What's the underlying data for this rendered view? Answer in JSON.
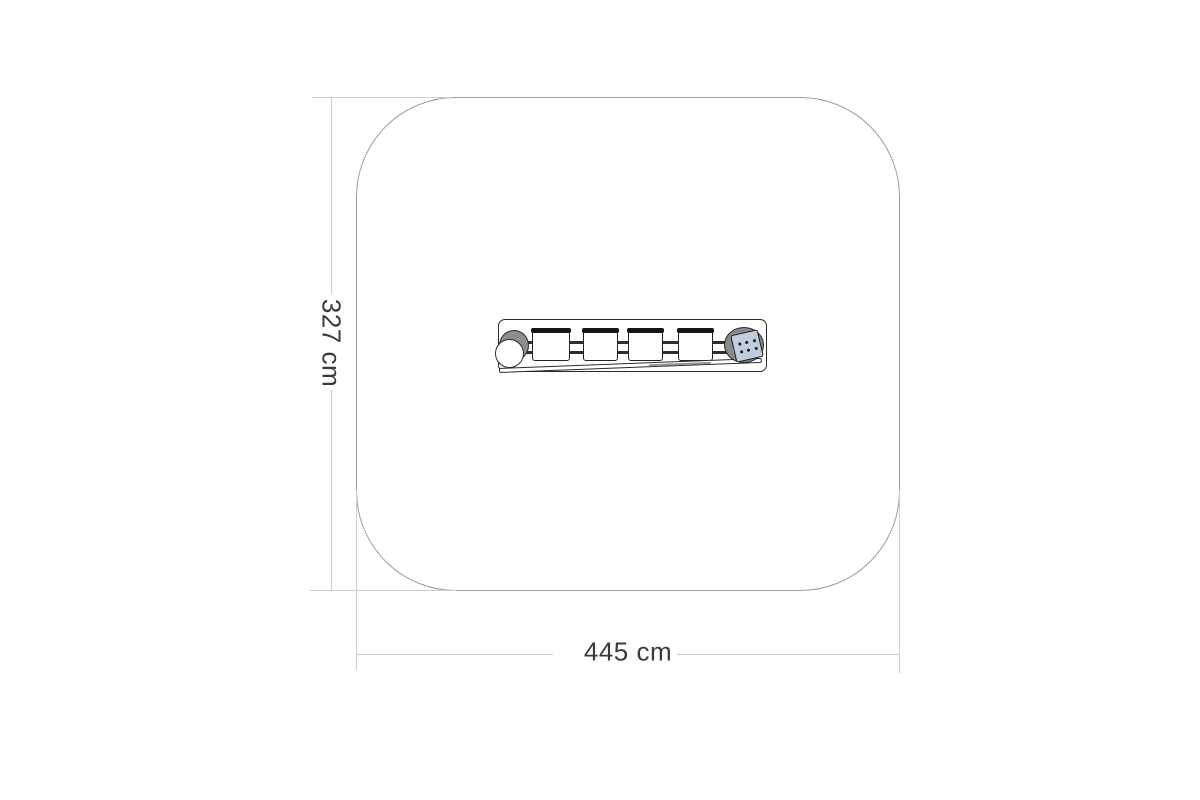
{
  "drawing": {
    "title": "playground-equipment-plan-view",
    "dimension_width": {
      "label": "445 cm",
      "value_cm": 445
    },
    "dimension_height": {
      "label": "327 cm",
      "value_cm": 327
    },
    "safety_zone": {
      "shape": "rounded-square",
      "outline_color": "#9c9c9c"
    },
    "equipment": {
      "pod_count": 4,
      "left_end": "cylinder-top-view",
      "right_end": "wheel-with-dice-panel",
      "dice_dot_count": 6,
      "colors": {
        "outline": "#2b2b2b",
        "metal_gray": "#8e8e8e",
        "dice_panel": "#bfcddc",
        "dimension_line": "#cccccc",
        "dimension_text": "#3a3a3a"
      }
    }
  }
}
